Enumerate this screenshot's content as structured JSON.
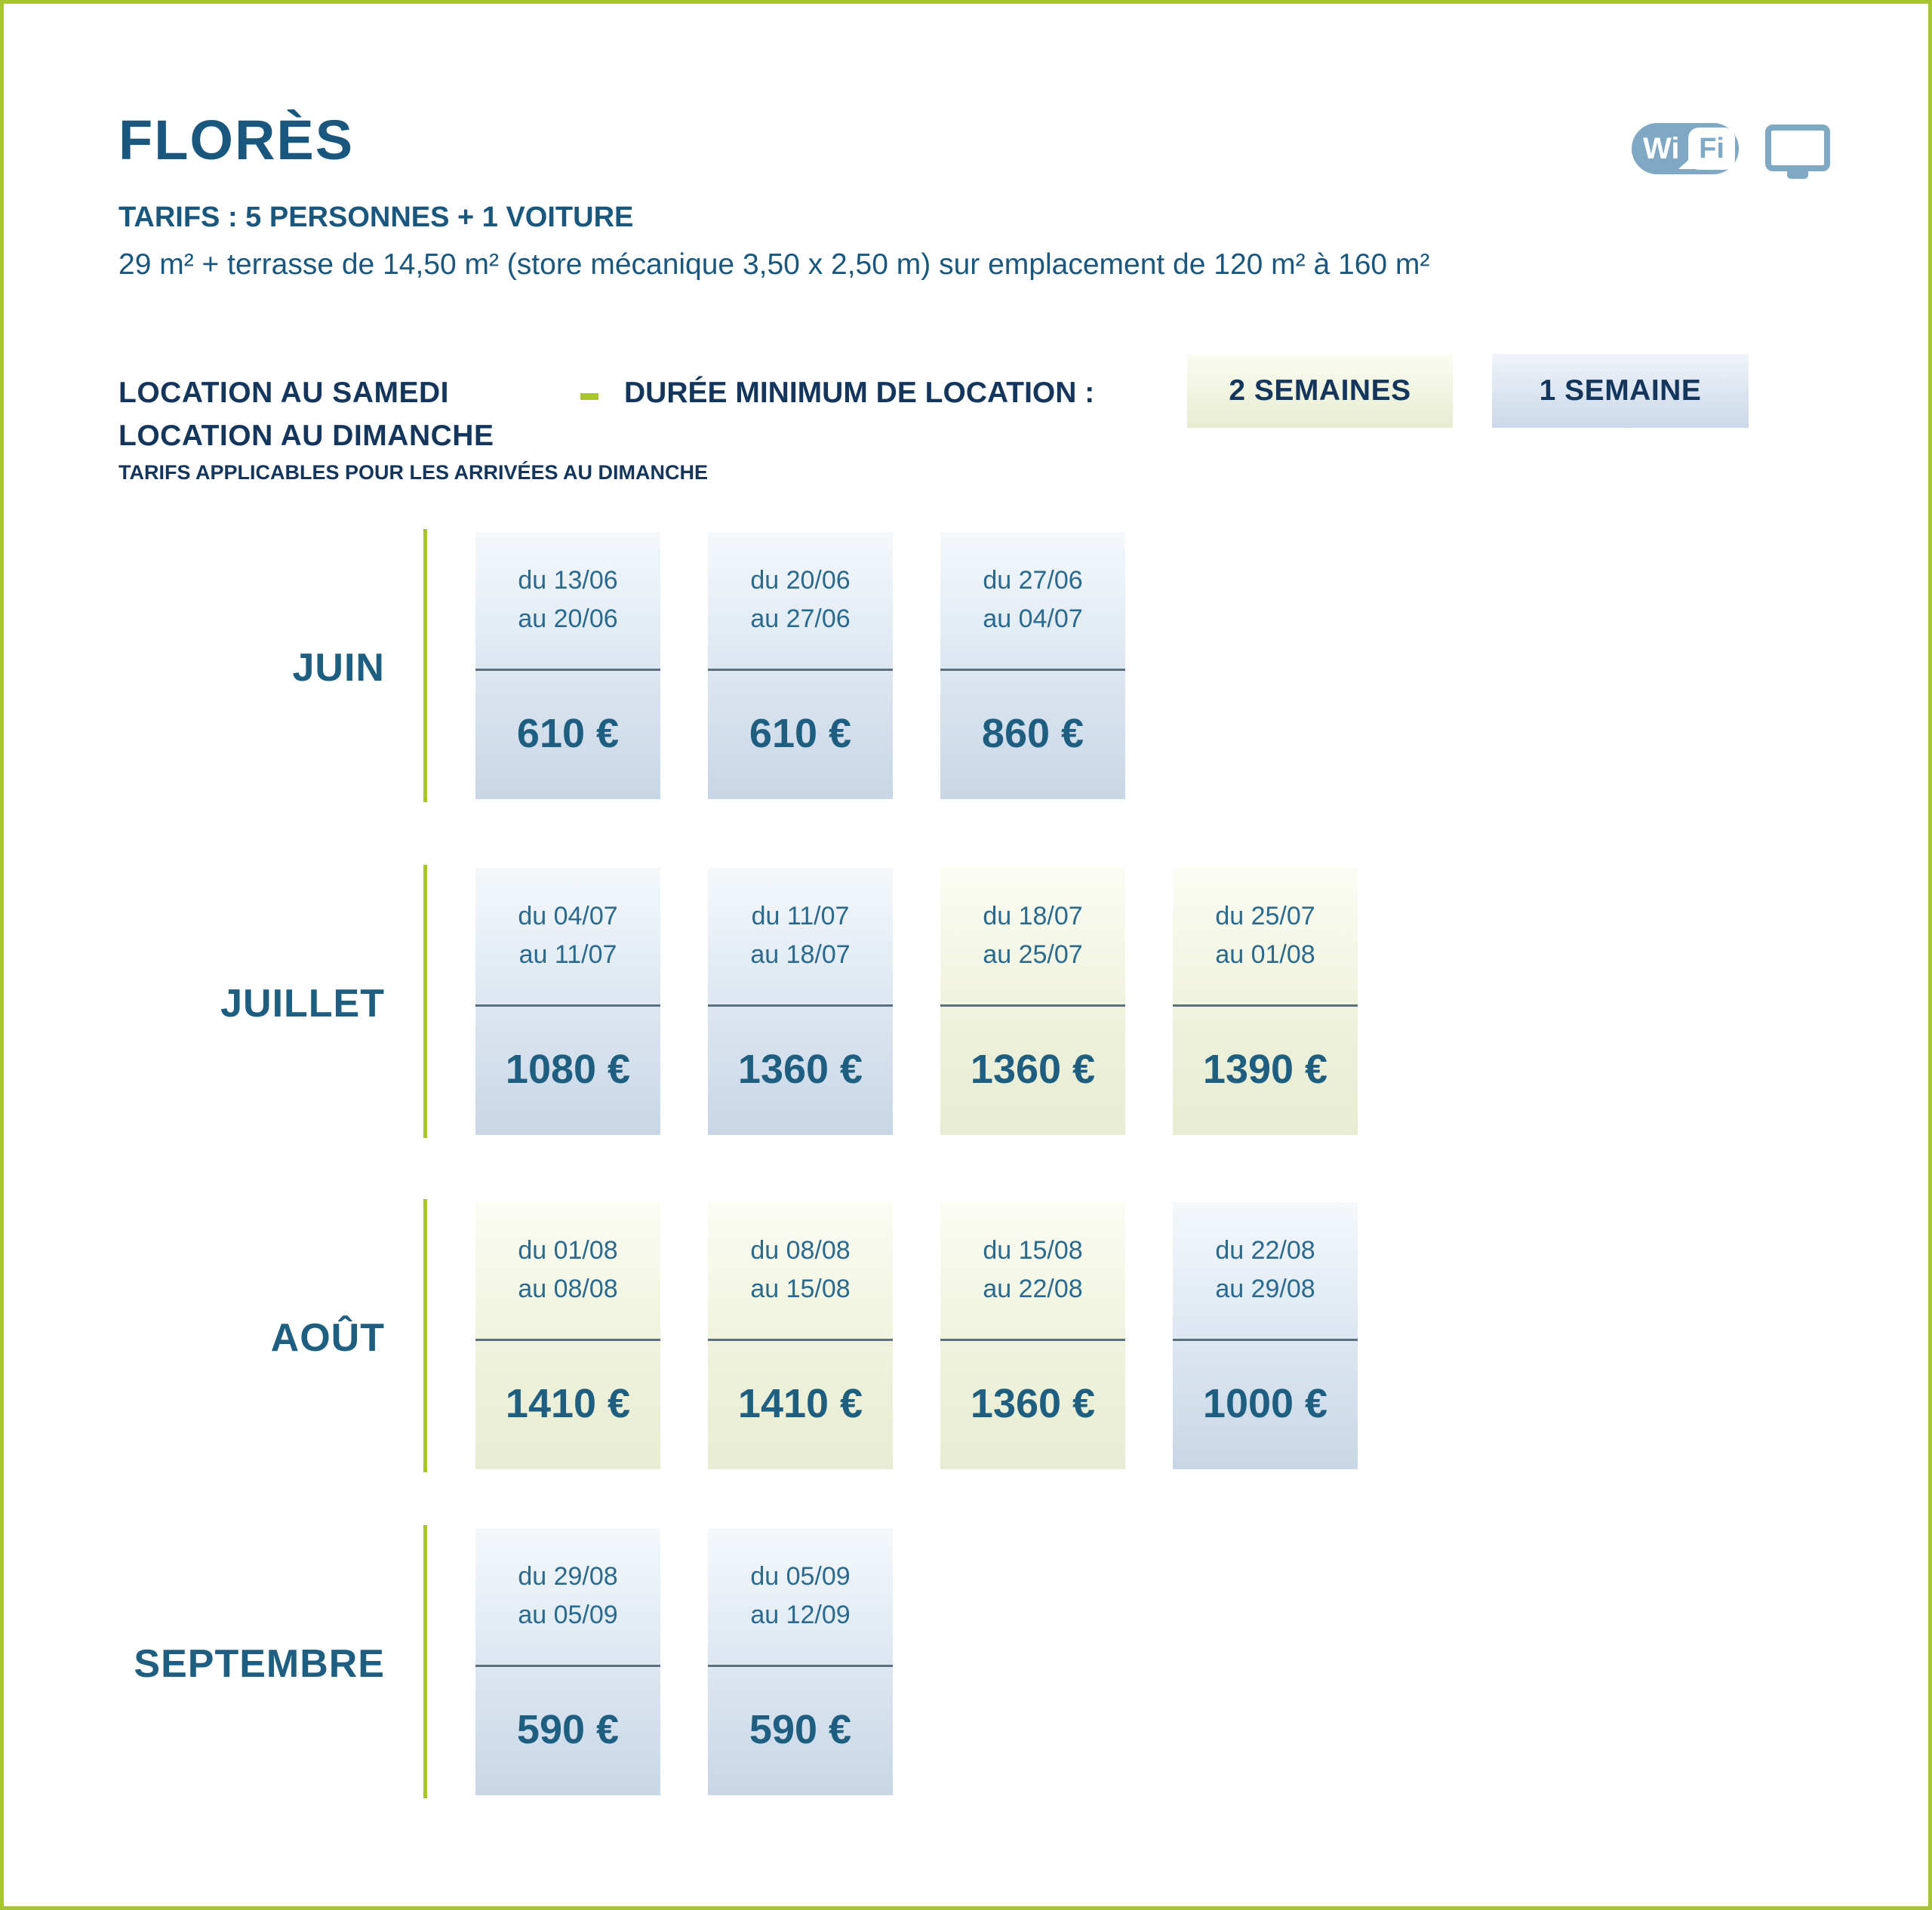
{
  "header": {
    "title": "FLORÈS",
    "subtitle": "TARIFS : 5 PERSONNES + 1 VOITURE",
    "description": "29 m² + terrasse de 14,50 m² (store mécanique 3,50 x 2,50 m) sur emplacement de 120 m² à 160 m²"
  },
  "icons": {
    "wifi": "wifi-icon",
    "wifi_wi": "Wi",
    "wifi_fi": "Fi",
    "tv": "tv-icon"
  },
  "booking": {
    "location_line1": "LOCATION AU SAMEDI",
    "location_line2": "LOCATION AU DIMANCHE",
    "location_note": "TARIFS APPLICABLES POUR LES ARRIVÉES AU DIMANCHE",
    "duration_label": "DURÉE MINIMUM DE LOCATION :",
    "badges": [
      {
        "label": "2 SEMAINES",
        "variant": "green"
      },
      {
        "label": "1 SEMAINE",
        "variant": "blue"
      }
    ]
  },
  "months": [
    {
      "name": "JUIN",
      "cards": [
        {
          "from": "du 13/06",
          "to": "au 20/06",
          "price": "610 €",
          "variant": "blue"
        },
        {
          "from": "du 20/06",
          "to": "au 27/06",
          "price": "610 €",
          "variant": "blue"
        },
        {
          "from": "du 27/06",
          "to": "au 04/07",
          "price": "860 €",
          "variant": "blue"
        }
      ]
    },
    {
      "name": "JUILLET",
      "cards": [
        {
          "from": "du 04/07",
          "to": "au 11/07",
          "price": "1080 €",
          "variant": "blue"
        },
        {
          "from": "du 11/07",
          "to": "au 18/07",
          "price": "1360 €",
          "variant": "blue"
        },
        {
          "from": "du 18/07",
          "to": "au 25/07",
          "price": "1360 €",
          "variant": "green"
        },
        {
          "from": "du 25/07",
          "to": "au 01/08",
          "price": "1390 €",
          "variant": "green"
        }
      ]
    },
    {
      "name": "AOÛT",
      "cards": [
        {
          "from": "du 01/08",
          "to": "au 08/08",
          "price": "1410 €",
          "variant": "green"
        },
        {
          "from": "du 08/08",
          "to": "au 15/08",
          "price": "1410 €",
          "variant": "green"
        },
        {
          "from": "du 15/08",
          "to": "au 22/08",
          "price": "1360 €",
          "variant": "green"
        },
        {
          "from": "du 22/08",
          "to": "au 29/08",
          "price": "1000 €",
          "variant": "blue"
        }
      ]
    },
    {
      "name": "SEPTEMBRE",
      "cards": [
        {
          "from": "du 29/08",
          "to": "au 05/09",
          "price": "590 €",
          "variant": "blue"
        },
        {
          "from": "du 05/09",
          "to": "au 12/09",
          "price": "590 €",
          "variant": "blue"
        }
      ]
    }
  ],
  "colors": {
    "lime": "#a6c52f",
    "navy": "#14365c",
    "petrol": "#19577e",
    "dateblue": "#2a6a8f",
    "priceblue": "#1d5e81",
    "iconblue": "#7fa8c5",
    "cardblue": "#c8d6e5",
    "cardgreen": "#e7ecd2",
    "badgeblue": "#ccd9e9",
    "divider": "#5d707f"
  }
}
